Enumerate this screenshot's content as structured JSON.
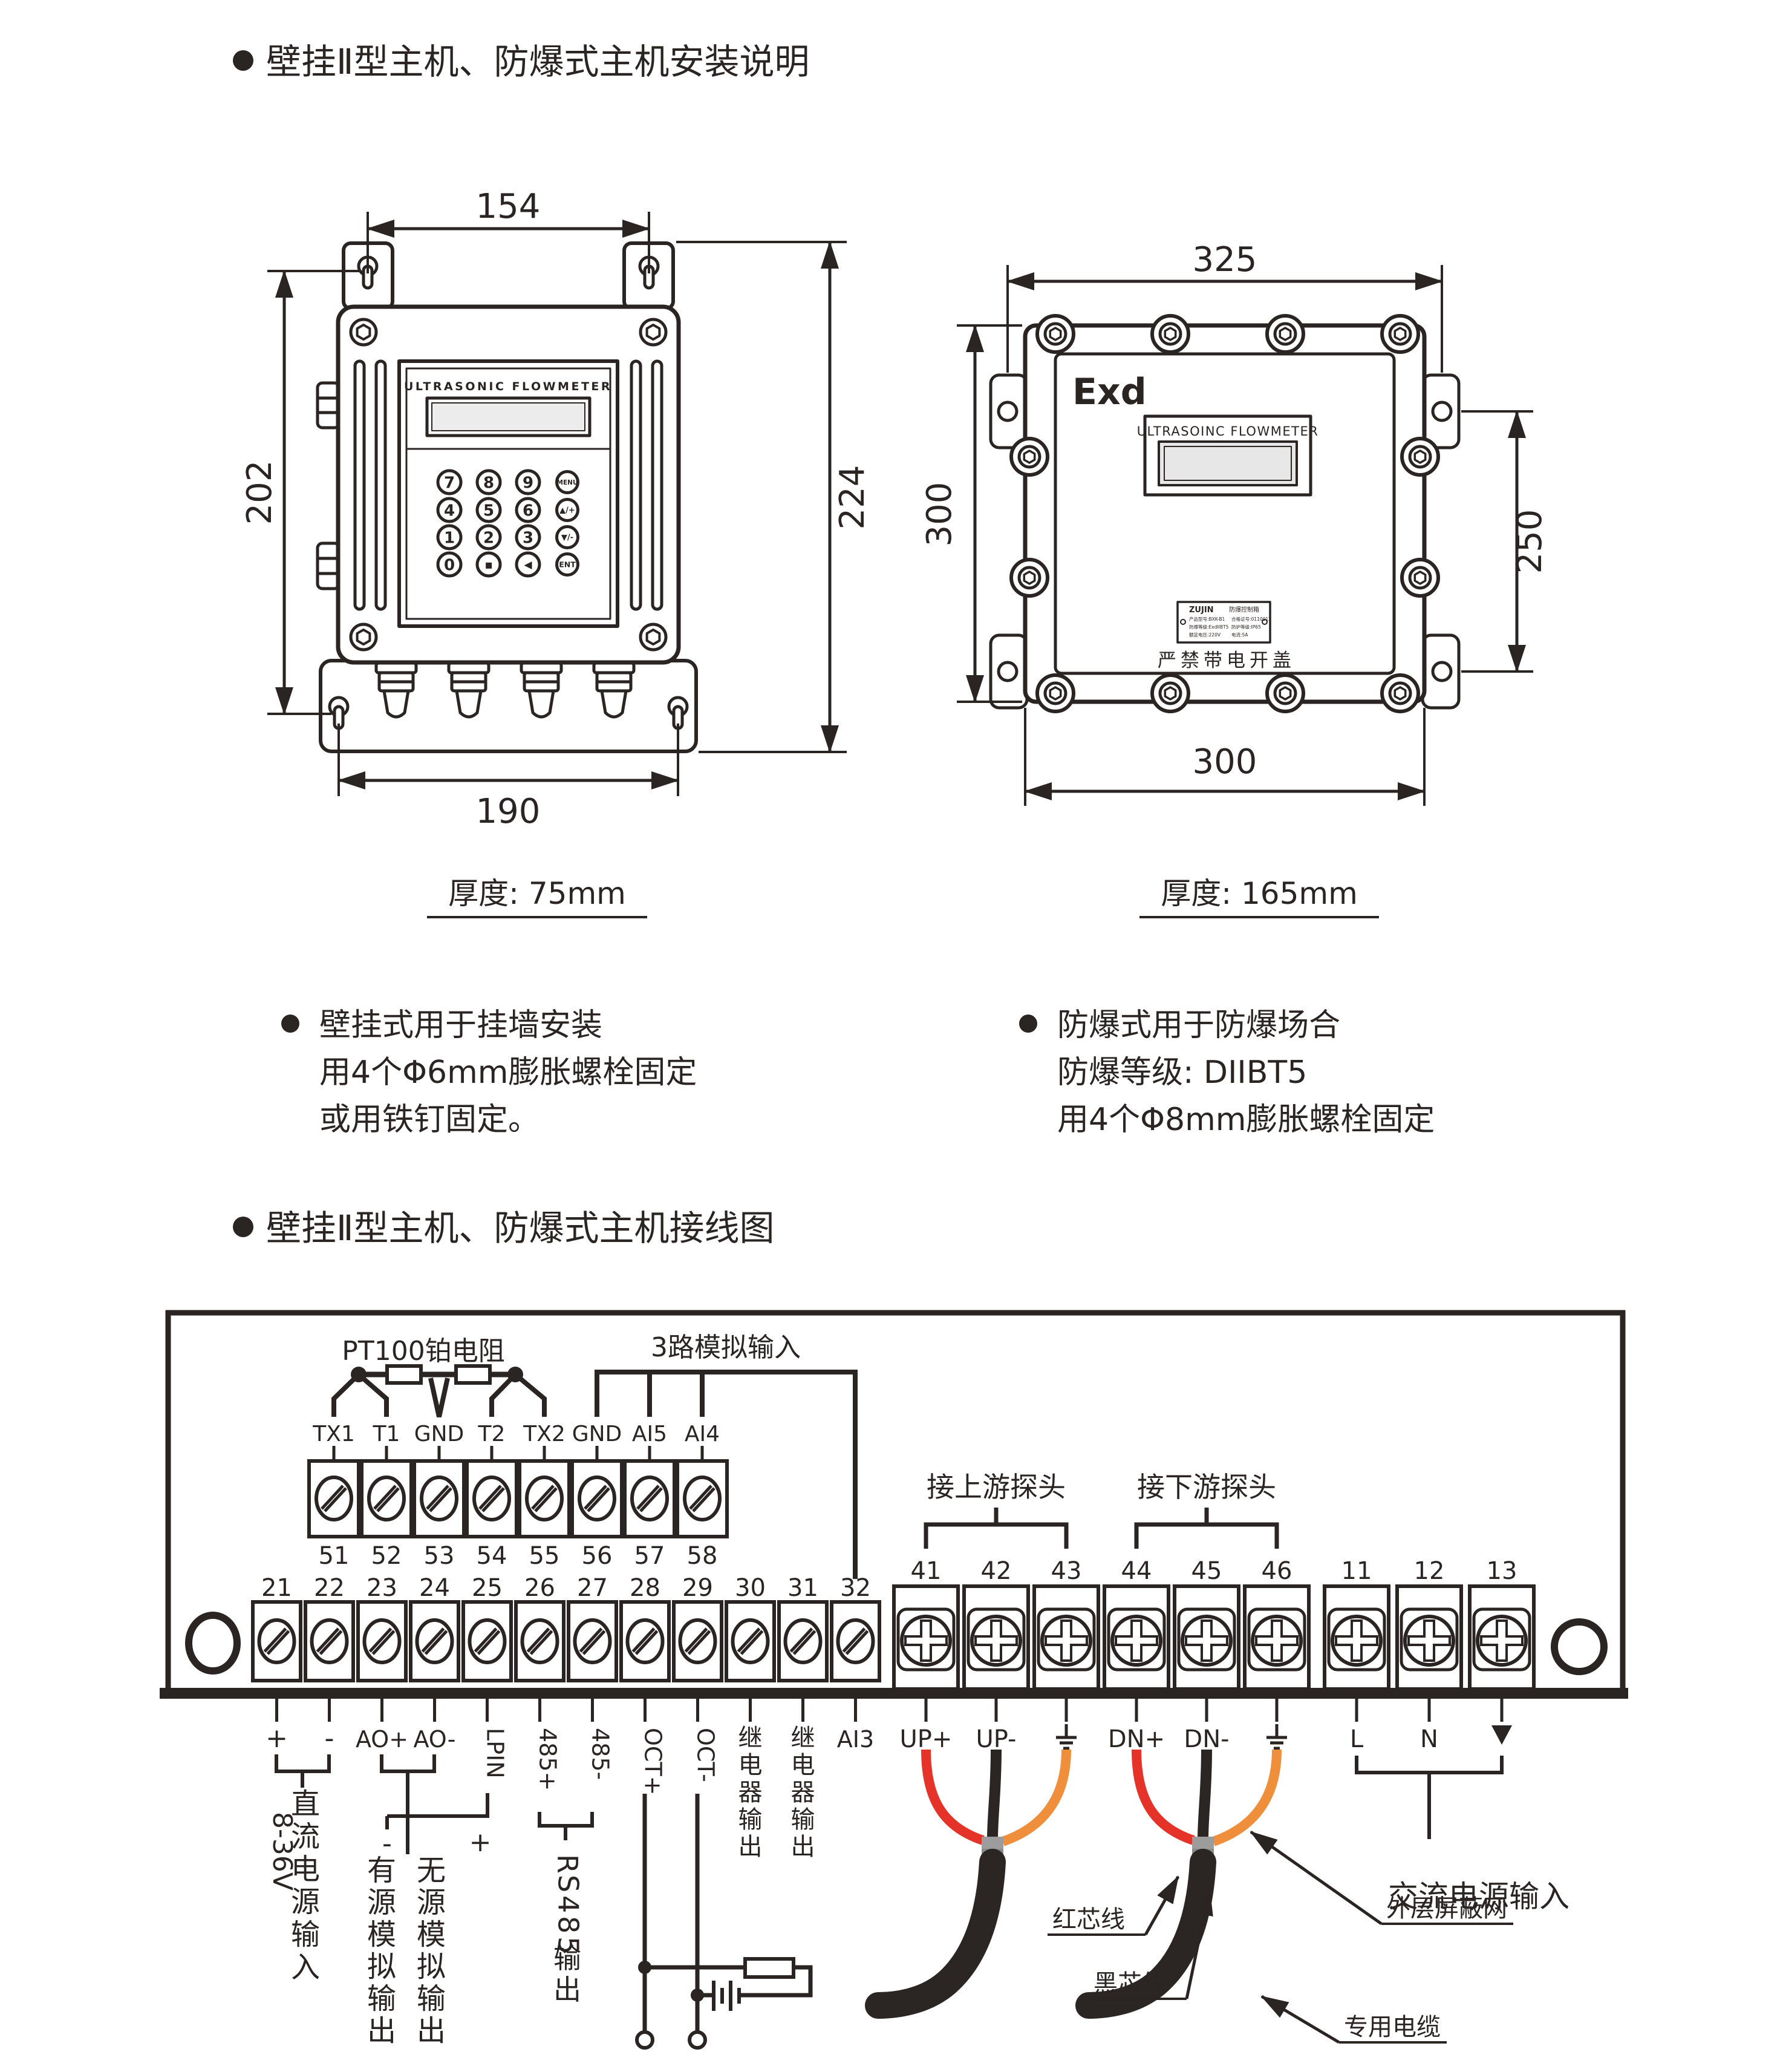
{
  "page": {
    "background": "#ffffff",
    "ink": "#2a2422"
  },
  "section1": {
    "title": "壁挂Ⅱ型主机、防爆式主机安装说明"
  },
  "section2": {
    "title": "壁挂Ⅱ型主机、防爆式主机接线图"
  },
  "device_left": {
    "brand_label": "ULTRASONIC FLOWMETER",
    "keypad": [
      [
        "7",
        "8",
        "9",
        "MENU"
      ],
      [
        "4",
        "5",
        "6",
        "▲/+"
      ],
      [
        "1",
        "2",
        "3",
        "▼/-"
      ],
      [
        "0",
        "▪",
        "◀",
        "ENT"
      ]
    ],
    "dims": {
      "top": "154",
      "left": "202",
      "right": "224",
      "bottom": "190"
    },
    "thickness": "厚度: 75mm",
    "notes": [
      "壁挂式用于挂墙安装",
      "用4个Φ6mm膨胀螺栓固定",
      "或用铁钉固定。"
    ]
  },
  "device_right": {
    "exd": "Exd",
    "brand_label": "ULTRASOINC FLOWMETER",
    "nameplate": {
      "brand": "ZUJIN",
      "title": "防爆控制箱",
      "rows": [
        [
          "产品型号:BXK-B1",
          "合格证号:0110013"
        ],
        [
          "防爆等级:ExdIIBT5",
          "防护等级:IP65"
        ],
        [
          "额定电压:220V",
          "电流:5A"
        ]
      ]
    },
    "warning": "严禁带电开盖",
    "dims": {
      "top": "325",
      "left": "300",
      "right": "250",
      "bottom": "300"
    },
    "thickness": "厚度: 165mm",
    "notes": [
      "防爆式用于防爆场合",
      "防爆等级: DIIBT5",
      "用4个Φ8mm膨胀螺栓固定"
    ]
  },
  "wiring": {
    "pt100_label": "PT100铂电阻",
    "analog_label": "3路模拟输入",
    "upper_terminals": [
      {
        "no": "51",
        "label": "TX1"
      },
      {
        "no": "52",
        "label": "T1"
      },
      {
        "no": "53",
        "label": "GND"
      },
      {
        "no": "54",
        "label": "T2"
      },
      {
        "no": "55",
        "label": "TX2"
      },
      {
        "no": "56",
        "label": "GND"
      },
      {
        "no": "57",
        "label": "AI5"
      },
      {
        "no": "58",
        "label": "AI4"
      }
    ],
    "lower_terminals": [
      {
        "no": "21",
        "label": "+"
      },
      {
        "no": "22",
        "label": "-"
      },
      {
        "no": "23",
        "label": "AO+"
      },
      {
        "no": "24",
        "label": "AO-"
      },
      {
        "no": "25",
        "label": "LPIN"
      },
      {
        "no": "26",
        "label": "485+"
      },
      {
        "no": "27",
        "label": "485-"
      },
      {
        "no": "28",
        "label": "OCT+"
      },
      {
        "no": "29",
        "label": "OCT-"
      },
      {
        "no": "30",
        "label": "继电器输出"
      },
      {
        "no": "31",
        "label": "继电器输出"
      },
      {
        "no": "32",
        "label": "AI3"
      }
    ],
    "cross_terminals": [
      {
        "no": "41",
        "label": "UP+"
      },
      {
        "no": "42",
        "label": "UP-"
      },
      {
        "no": "43",
        "label": "⏚"
      },
      {
        "no": "44",
        "label": "DN+"
      },
      {
        "no": "45",
        "label": "DN-"
      },
      {
        "no": "46",
        "label": "⏚"
      },
      {
        "no": "11",
        "label": "L"
      },
      {
        "no": "12",
        "label": "N"
      },
      {
        "no": "13",
        "label": "▼"
      }
    ],
    "upstream_label": "接上游探头",
    "downstream_label": "接下游探头",
    "dc_range": "8-36V",
    "dc_label": "直流电源输入",
    "active_out_minus": "-",
    "passive_out_plus": "+",
    "active_out": "有源模拟输出",
    "passive_out": "无源模拟输出",
    "rs485_label": "RS485输出",
    "ac_label": "交流电源输入",
    "callouts": {
      "red": "红芯线",
      "black": "黑芯线",
      "shield": "外层屏蔽网",
      "cable": "专用电缆"
    },
    "colors": {
      "red": "#e63329",
      "orange": "#ef8f3c",
      "cable": "#2b2523",
      "ferrule": "#9c9c9c",
      "ferrule2": "#8a8a8a"
    }
  }
}
